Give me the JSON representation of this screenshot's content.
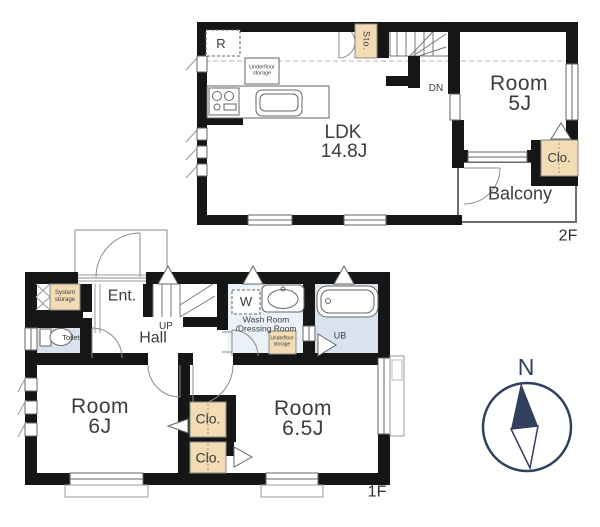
{
  "title": "2-story floor plan",
  "colors": {
    "wall": "#161616",
    "storage": "#f3dcb4",
    "water": "#d9e3f0",
    "washroom": "#ebf1f8",
    "compass": "#31405e",
    "text": "#3c3c3c",
    "line": "#666666"
  },
  "floor2": {
    "label": "2F",
    "ldk_name": "LDK",
    "ldk_size": "14.8J",
    "room5_name": "Room",
    "room5_size": "5J",
    "balcony": "Balcony",
    "closet": "Clo.",
    "storage": "Sto.",
    "fridge": "R",
    "underfloor": "Underfloor storage",
    "stairs_down": "DN"
  },
  "floor1": {
    "label": "1F",
    "entrance": "Ent.",
    "hall": "Hall",
    "stairs_up": "UP",
    "toilet": "Toilet",
    "system_storage": "System storage",
    "washer": "W",
    "washroom_line1": "Wash Room",
    "washroom_line2": "/Dressing Room",
    "underfloor": "Underfloor storage",
    "unit_bath": "UB",
    "room6_name": "Room",
    "room6_size": "6J",
    "room65_name": "Room",
    "room65_size": "6.5J",
    "closet1": "Clo.",
    "closet2": "Clo."
  },
  "compass": {
    "north": "N"
  }
}
